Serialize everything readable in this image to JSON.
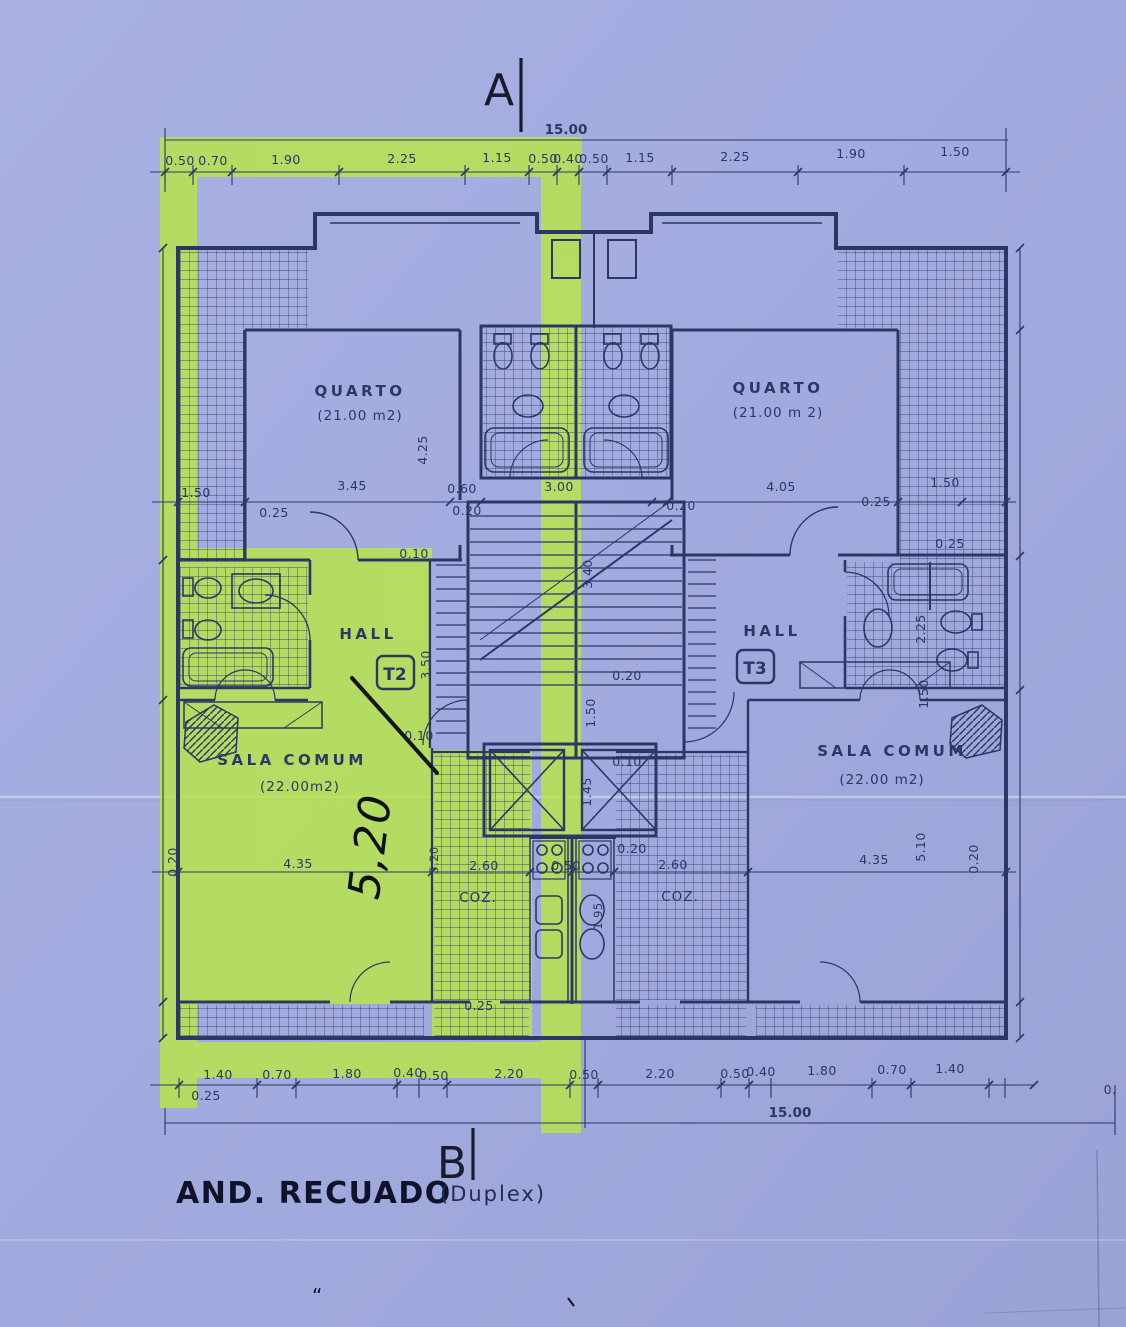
{
  "title_block": {
    "title": "AND. RECUADO",
    "subtitle": "(Duplex)"
  },
  "section_markers": {
    "top": "A",
    "bottom": "B"
  },
  "overall_dims": {
    "top": "15.00",
    "bottom": "15.00"
  },
  "top_chain": [
    "0.50",
    "0.70",
    "1.90",
    "2.25",
    "1.15",
    "0.50",
    "0.40",
    "0.50",
    "1.15",
    "2.25",
    "1.90",
    "1.50"
  ],
  "bottom_chain": [
    "1.40",
    "0.70",
    "1.80",
    "0.40",
    "0.50",
    "2.20",
    "0.50",
    "2.20",
    "0.50",
    "0.40",
    "1.80",
    "0.70",
    "1.40"
  ],
  "bottom_chain_offsets": {
    "left": "0.25",
    "right": "0."
  },
  "rooms": {
    "quarto_left": {
      "name": "QUARTO",
      "area": "(21.00 m2)"
    },
    "quarto_right": {
      "name": "QUARTO",
      "area": "(21.00 m 2)"
    },
    "hall_left": {
      "name": "HALL",
      "unit": "T2"
    },
    "hall_right": {
      "name": "HALL",
      "unit": "T3"
    },
    "sala_left": {
      "name": "SALA COMUM",
      "area": "(22.00m2)"
    },
    "sala_right": {
      "name": "SALA COMUM",
      "area": "(22.00 m2)"
    },
    "kitchen_left": {
      "name": "COZ."
    },
    "kitchen_right": {
      "name": "COZ."
    }
  },
  "inner_dims": {
    "terrace_left": "1.50",
    "quarto_left_w": "3.45",
    "offset_a": "0.25",
    "closet_w": "0.60",
    "wall_a": "0.20",
    "bath_center_w": "3.00",
    "wall_b": "0.20",
    "quarto_right_w": "4.05",
    "offset_b": "0.25",
    "terrace_right": "1.50",
    "offset_c": "0.25",
    "wall_c": "0.10",
    "quarto_left_h": "4.25",
    "stair_len": "3.40",
    "hall_left_h": "3.50",
    "bath_right_h1": "2.25",
    "bath_right_h2": "1.50",
    "wall_d": "0.20",
    "lobby_h": "1.50",
    "wall_e": "0.10",
    "wall_f": "0.10",
    "elevator_w": "1.45",
    "sala_left_wall": "0.20",
    "sala_left_w": "4.35",
    "sala_left_h": "5.20",
    "kitchen_left_w": "2.60",
    "kitchen_gap": "0.50",
    "wall_g": "0.20",
    "kitchen_right_w": "2.60",
    "kitchen_right_h": "1.95",
    "sala_right_w": "4.35",
    "sala_right_h": "5.10",
    "sala_right_wall": "0.20",
    "balcony_wall": "0.25"
  },
  "annotations": {
    "handwritten_length": "5,20"
  },
  "colors": {
    "paper": "#a3ace0",
    "ink": "#2c3765",
    "highlighter": "#b9e843",
    "pen": "#15151f"
  }
}
